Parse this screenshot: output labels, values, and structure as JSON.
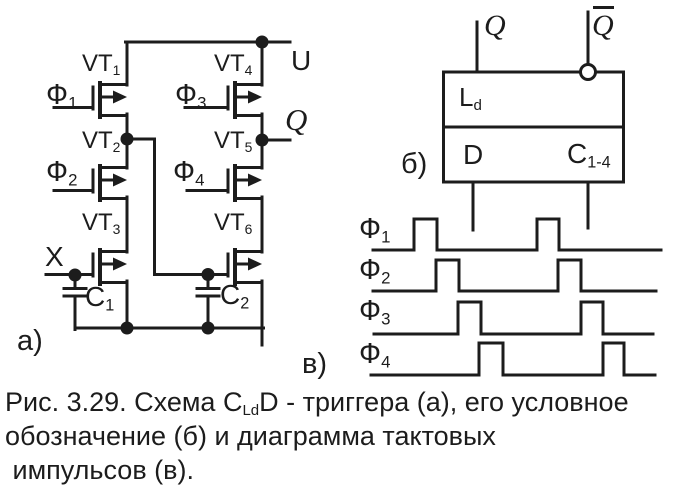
{
  "schematic_a": {
    "panel_label": "а)",
    "supply_label": "U",
    "output_label": "Q",
    "input_label": "X",
    "transistors": [
      {
        "base": "VT",
        "sub": "1"
      },
      {
        "base": "VT",
        "sub": "2"
      },
      {
        "base": "VT",
        "sub": "3"
      },
      {
        "base": "VT",
        "sub": "4"
      },
      {
        "base": "VT",
        "sub": "5"
      },
      {
        "base": "VT",
        "sub": "6"
      }
    ],
    "clock_inputs": [
      {
        "base": "Ф",
        "sub": "1"
      },
      {
        "base": "Ф",
        "sub": "2"
      },
      {
        "base": "Ф",
        "sub": "3"
      },
      {
        "base": "Ф",
        "sub": "4"
      }
    ],
    "capacitors": [
      {
        "base": "C",
        "sub": "1"
      },
      {
        "base": "C",
        "sub": "2"
      }
    ]
  },
  "symbol_b": {
    "panel_label": "б)",
    "q_label": "Q",
    "q_inv_label": "Q",
    "latch_label": {
      "base": "L",
      "sub": "d"
    },
    "d_input_label": "D",
    "clock_input_label": {
      "base": "C",
      "sub": "1-4"
    }
  },
  "timing_v": {
    "panel_label": "в)",
    "phases": [
      {
        "id": "f1",
        "label": {
          "base": "Ф",
          "sub": "1"
        },
        "x_start": 373,
        "x_end": 661,
        "base_y": 250,
        "high_y": 219,
        "pulses": [
          [
            414,
            437
          ],
          [
            537,
            559
          ]
        ]
      },
      {
        "id": "f2",
        "label": {
          "base": "Ф",
          "sub": "2"
        },
        "x_start": 373,
        "x_end": 656,
        "base_y": 291,
        "high_y": 260,
        "pulses": [
          [
            436,
            459
          ],
          [
            558,
            581
          ]
        ]
      },
      {
        "id": "f3",
        "label": {
          "base": "Ф",
          "sub": "3"
        },
        "x_start": 374,
        "x_end": 653,
        "base_y": 334,
        "high_y": 302,
        "pulses": [
          [
            458,
            481
          ],
          [
            581,
            603
          ]
        ]
      },
      {
        "id": "f4",
        "label": {
          "base": "Ф",
          "sub": "4"
        },
        "x_start": 371,
        "x_end": 655,
        "base_y": 375,
        "high_y": 343,
        "pulses": [
          [
            479,
            503
          ],
          [
            603,
            624
          ]
        ]
      }
    ]
  },
  "caption": {
    "line1_pre": "Рис. 3.29. Схема С",
    "line1_sub": "Ld",
    "line1_post": "D - триггера (а), его условное",
    "line2": "обозначение (б) и диаграмма тактовых",
    "line3": " импульсов (в)."
  }
}
